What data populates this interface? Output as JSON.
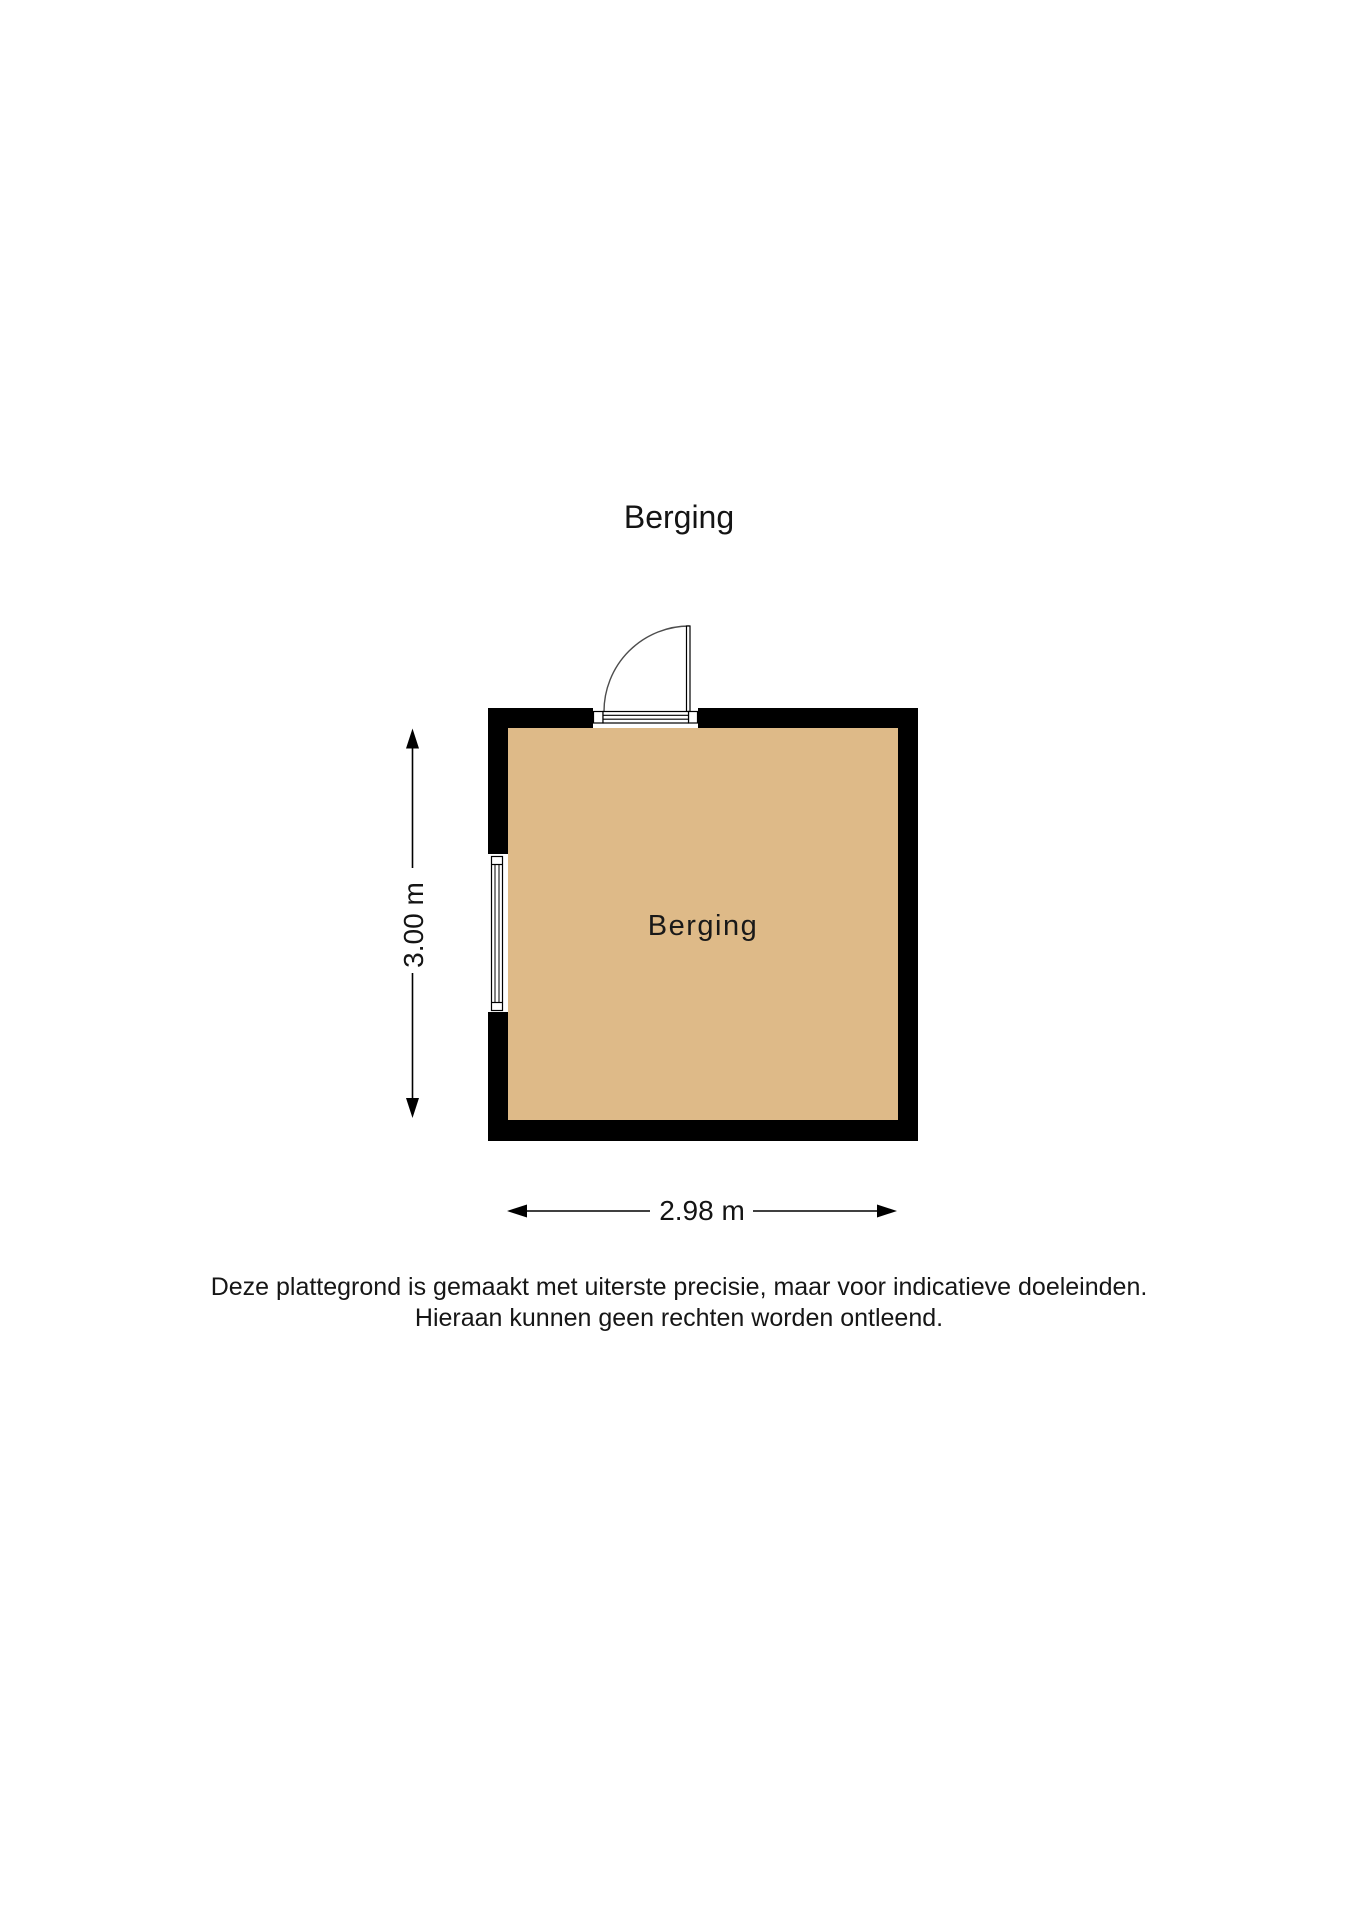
{
  "page_title": "Berging",
  "plan": {
    "room_label": "Berging",
    "dim_width_label": "2.98 m",
    "dim_height_label": "3.00 m",
    "colors": {
      "floor": "#deba88",
      "wall": "#000000"
    }
  },
  "disclaimer": {
    "line1": "Deze plattegrond is gemaakt met uiterste precisie, maar voor indicatieve doeleinden.",
    "line2": "Hieraan kunnen geen rechten worden ontleend."
  }
}
